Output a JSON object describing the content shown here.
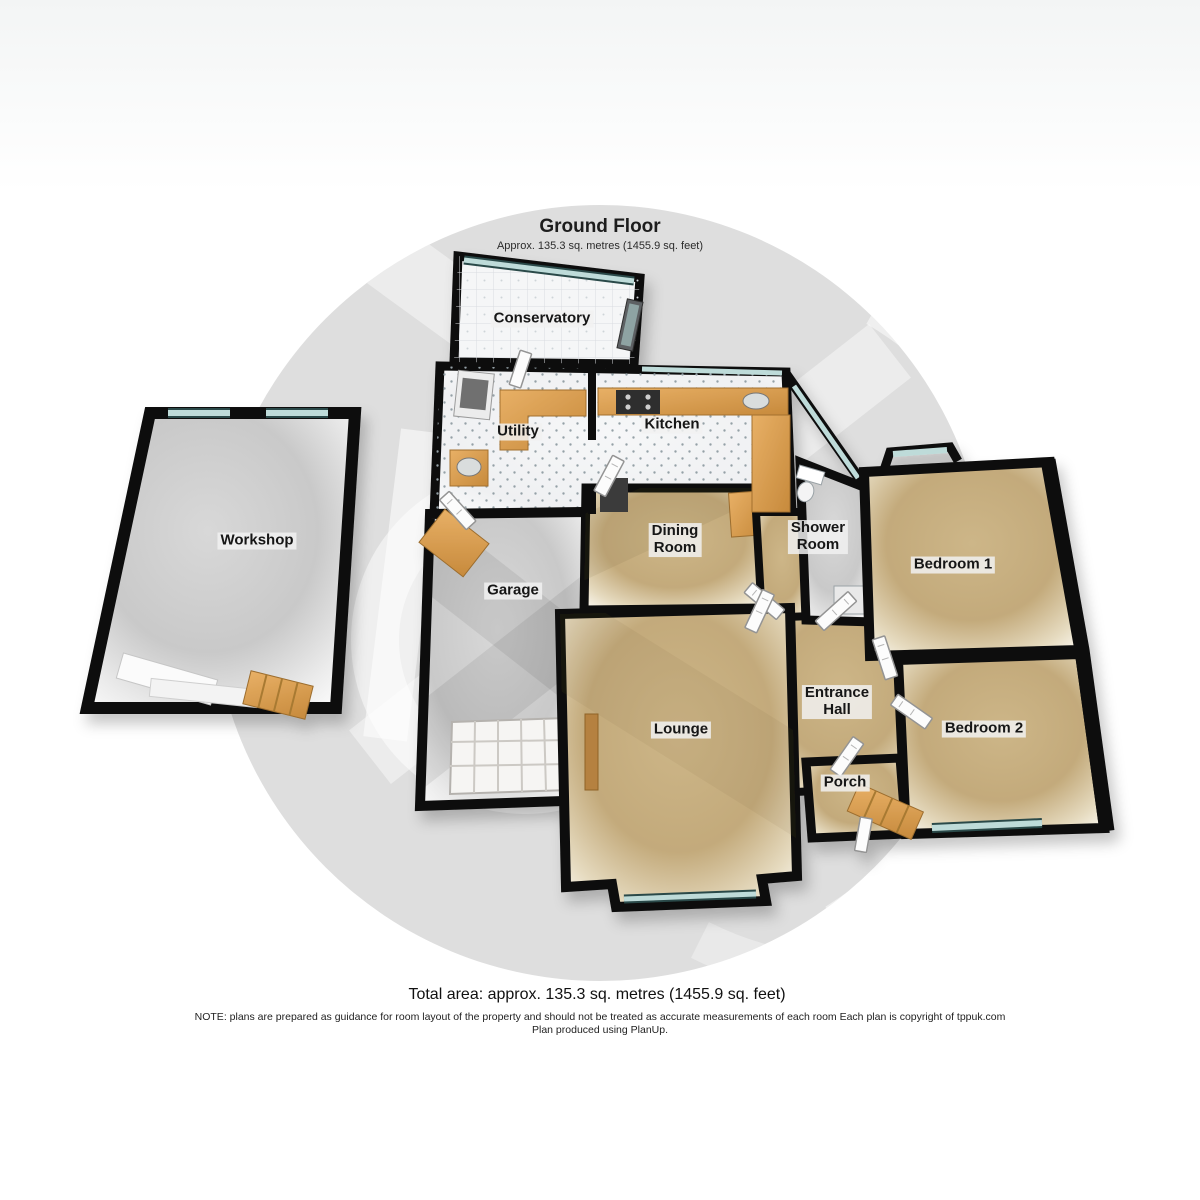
{
  "header": {
    "title": "Ground Floor",
    "subtitle": "Approx. 135.3 sq. metres (1455.9 sq. feet)"
  },
  "rooms": {
    "conservatory": {
      "label": "Conservatory"
    },
    "utility": {
      "label": "Utility"
    },
    "kitchen": {
      "label": "Kitchen"
    },
    "dining_room": {
      "line1": "Dining",
      "line2": "Room"
    },
    "shower_room": {
      "line1": "Shower",
      "line2": "Room"
    },
    "bedroom1": {
      "label": "Bedroom 1"
    },
    "workshop": {
      "label": "Workshop"
    },
    "garage": {
      "label": "Garage"
    },
    "lounge": {
      "label": "Lounge"
    },
    "entrance_hall": {
      "line1": "Entrance",
      "line2": "Hall"
    },
    "bedroom2": {
      "label": "Bedroom 2"
    },
    "porch": {
      "label": "Porch"
    }
  },
  "footer": {
    "total_area": "Total area: approx. 135.3 sq. metres (1455.9 sq. feet)",
    "note_line1": "NOTE: plans are prepared as guidance for room layout of the property and should not be treated as accurate measurements of each room Each plan is copyright of tppuk.com",
    "note_line2": "Plan produced using PlanUp."
  },
  "colors": {
    "wall": "#0e0e0e",
    "carpet": "#c6ae7f",
    "tile_floor": "#f4f5f6",
    "concrete_floor": "#cccccc",
    "window_glass": "#bedbd9",
    "counter_wood": "#dd9f54",
    "watermark_circle": "#dedede"
  }
}
